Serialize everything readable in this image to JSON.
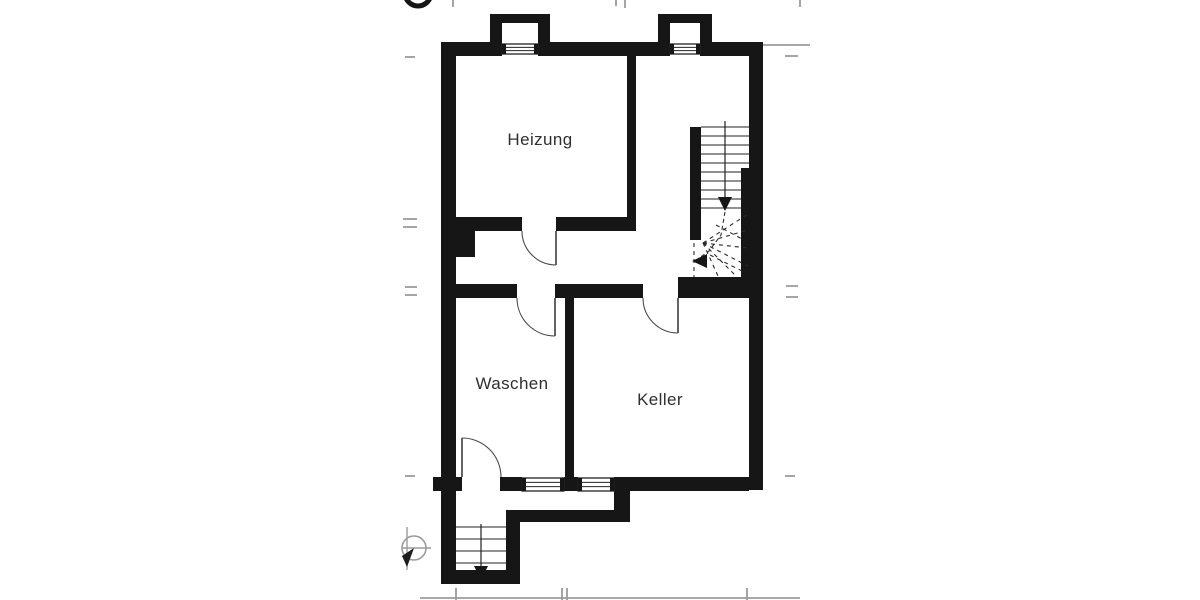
{
  "plan": {
    "drawing_type": "basement floor plan",
    "colors": {
      "wall": "#161616",
      "line": "#222222",
      "annotation_gray": "#9b9b9b",
      "background": "#ffffff",
      "label_text": "#2f2f2f"
    },
    "rooms": [
      {
        "id": "heizung",
        "label": "Heizung",
        "cx": 540,
        "cy": 140
      },
      {
        "id": "waschen",
        "label": "Waschen",
        "cx": 512,
        "cy": 384
      },
      {
        "id": "keller",
        "label": "Keller",
        "cx": 660,
        "cy": 400
      }
    ],
    "walls": [
      [
        441,
        42,
        15,
        542
      ],
      [
        441,
        42,
        61,
        14
      ],
      [
        538,
        42,
        132,
        14
      ],
      [
        700,
        42,
        63,
        14
      ],
      [
        490,
        14,
        60,
        9
      ],
      [
        490,
        14,
        12,
        28
      ],
      [
        538,
        14,
        12,
        28
      ],
      [
        658,
        14,
        54,
        9
      ],
      [
        658,
        14,
        12,
        28
      ],
      [
        700,
        14,
        12,
        28
      ],
      [
        749,
        42,
        14,
        448
      ],
      [
        741,
        168,
        8,
        129
      ],
      [
        627,
        56,
        9,
        175
      ],
      [
        456,
        217,
        66,
        14
      ],
      [
        556,
        217,
        80,
        14
      ],
      [
        456,
        231,
        19,
        26
      ],
      [
        441,
        284,
        76,
        14
      ],
      [
        555,
        284,
        88,
        14
      ],
      [
        678,
        277,
        71,
        21
      ],
      [
        690,
        127,
        11,
        113
      ],
      [
        565,
        284,
        9,
        193
      ],
      [
        614,
        477,
        135,
        14
      ],
      [
        500,
        477,
        22,
        14
      ],
      [
        564,
        477,
        14,
        14
      ],
      [
        433,
        477,
        29,
        14
      ],
      [
        614,
        491,
        16,
        31
      ],
      [
        506,
        510,
        108,
        12
      ],
      [
        506,
        522,
        14,
        62
      ],
      [
        441,
        570,
        79,
        14
      ]
    ],
    "windows": [
      {
        "x": 502,
        "y": 44,
        "w": 36,
        "h": 10
      },
      {
        "x": 670,
        "y": 44,
        "w": 30,
        "h": 10
      },
      {
        "x": 522,
        "y": 478,
        "w": 42,
        "h": 13
      },
      {
        "x": 578,
        "y": 478,
        "w": 36,
        "h": 13
      }
    ],
    "doors": [
      {
        "name": "door-heizung",
        "leaf": "M556 231 L556 265",
        "arc": "M522 231 A34 34 0 0 0 556 265"
      },
      {
        "name": "door-waschen",
        "leaf": "M555 298 L555 336",
        "arc": "M517 298 A38 38 0 0 0 555 336"
      },
      {
        "name": "door-keller",
        "leaf": "M678 298 L678 333",
        "arc": "M643 298 A35 35 0 0 0 678 333"
      },
      {
        "name": "door-waschen-exit",
        "leaf": "M462 438 L462 477",
        "arc": "M462 438 A39 39 0 0 1 501 477"
      }
    ],
    "stair_main": {
      "treads": [
        [
          701,
          127,
          749
        ],
        [
          701,
          136,
          749
        ],
        [
          701,
          145,
          749
        ],
        [
          701,
          154,
          749
        ],
        [
          701,
          163,
          749
        ],
        [
          701,
          172,
          741
        ],
        [
          701,
          181,
          741
        ],
        [
          701,
          190,
          741
        ],
        [
          701,
          199,
          741
        ],
        [
          701,
          208,
          741
        ]
      ],
      "walk_line": "M725 121 L725 197",
      "arrow_down": "718,197 732,197 725,211",
      "winder_dashes": [
        [
          703,
          243,
          748,
          214
        ],
        [
          703,
          243,
          748,
          230
        ],
        [
          703,
          243,
          748,
          248
        ],
        [
          703,
          243,
          748,
          266
        ],
        [
          703,
          243,
          736,
          276
        ],
        [
          703,
          243,
          718,
          276
        ],
        [
          694,
          243,
          694,
          277
        ],
        [
          710,
          255,
          744,
          272
        ],
        [
          716,
          225,
          744,
          240
        ]
      ],
      "walk_dashed": "M725 212 L721 235 L709 251 L698 259",
      "arrow_left": "707,254 707,268 692,261"
    },
    "stair_areaway": {
      "treads": [
        [
          456,
          527,
          506
        ],
        [
          456,
          539,
          506
        ],
        [
          456,
          551,
          506
        ],
        [
          456,
          563,
          506
        ]
      ],
      "walk_line": "M481 524 L481 566",
      "arrow_down": "474,566 488,566 481,580"
    },
    "annotations": {
      "gray_lines": [
        [
          405,
          57,
          415,
          57
        ],
        [
          403,
          219,
          417,
          219
        ],
        [
          403,
          227,
          417,
          227
        ],
        [
          405,
          287,
          417,
          287
        ],
        [
          405,
          295,
          417,
          295
        ],
        [
          405,
          476,
          415,
          476
        ],
        [
          785,
          56,
          798,
          56
        ],
        [
          786,
          286,
          798,
          286
        ],
        [
          786,
          297,
          798,
          297
        ],
        [
          785,
          476,
          795,
          476
        ],
        [
          453,
          0,
          453,
          7
        ],
        [
          616,
          0,
          616,
          6
        ],
        [
          625,
          0,
          625,
          8
        ],
        [
          800,
          0,
          800,
          7
        ],
        [
          763,
          45,
          810,
          45
        ],
        [
          420,
          598,
          800,
          598
        ],
        [
          456,
          588,
          456,
          600
        ],
        [
          562,
          588,
          562,
          600
        ],
        [
          567,
          588,
          567,
          600
        ],
        [
          747,
          588,
          747,
          600
        ]
      ],
      "neighbor_symbol": {
        "circle": {
          "cx": 414,
          "cy": 548,
          "r": 12
        },
        "lines": [
          [
            402,
            548,
            431,
            548
          ],
          [
            407,
            527,
            407,
            570
          ]
        ],
        "wedge": "M414 548 L402 556 L407 567 Z"
      },
      "north_circle": {
        "cx": 418,
        "cy": -7,
        "r": 13,
        "stroke_width": 5
      }
    }
  }
}
